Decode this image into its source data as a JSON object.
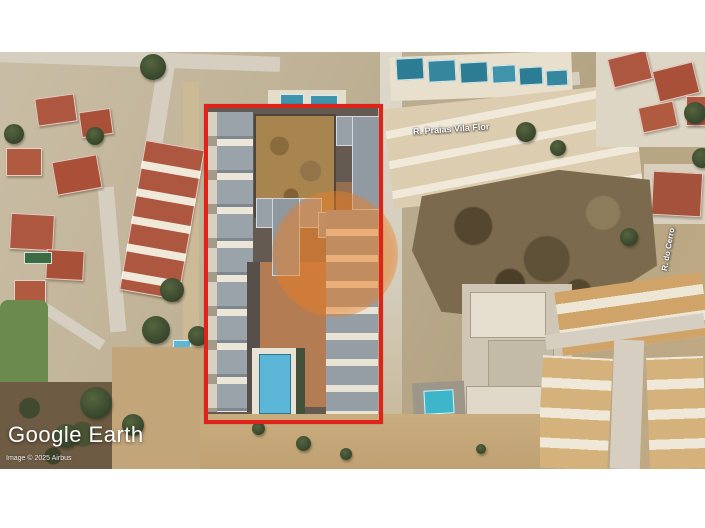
{
  "attribution": {
    "logo": "Google Earth",
    "copyright": "Image © 2025 Airbus"
  },
  "labels": {
    "street_top": "R. Praias Vila Flor",
    "street_right": "R. do Cerro"
  },
  "annotation": {
    "highlight_shape": "red-rectangle-outline",
    "watermark_shape": "orange-circle"
  },
  "theme": {
    "boundary_red": "#e02318",
    "watermark_orange": "rgba(234,125,34,0.52)",
    "pool_blue": "#5cb6d8",
    "pool_teal": "#2c7c93",
    "roof_terracotta": "#ad5740",
    "roof_gray": "#9aa2aa",
    "roof_gold": "#d0a468",
    "field_brown": "#7b6a4d"
  }
}
